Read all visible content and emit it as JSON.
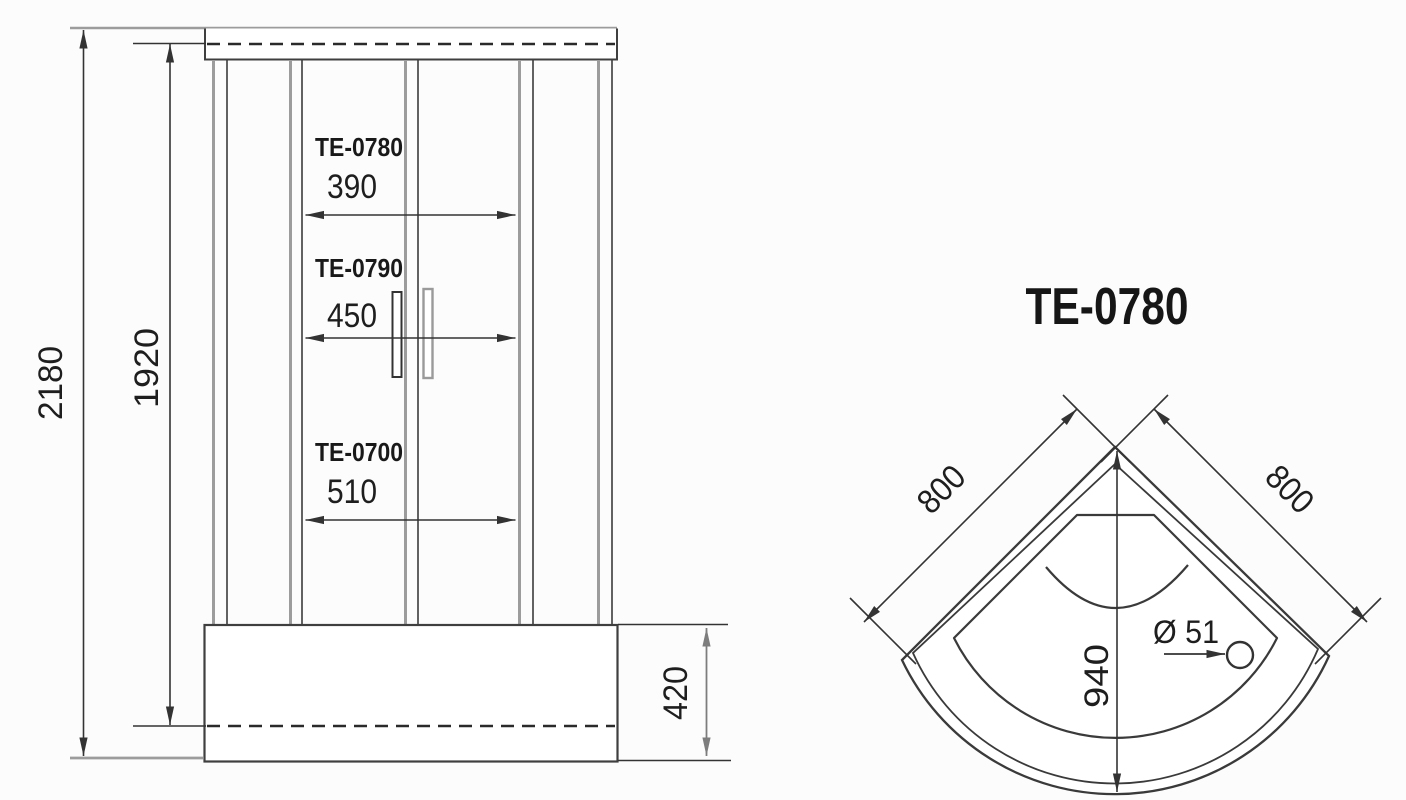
{
  "drawing": {
    "front_view": {
      "overall_height": "2180",
      "door_opening_height": "1920",
      "tray_height": "420",
      "variants": [
        {
          "model": "TE-0780",
          "door_width": "390"
        },
        {
          "model": "TE-0790",
          "door_width": "450"
        },
        {
          "model": "TE-0700",
          "door_width": "510"
        }
      ]
    },
    "plan_view": {
      "title": "TE-0780",
      "side_left": "800",
      "side_right": "800",
      "depth_diagonal": "940",
      "drain_diameter": "Ø 51"
    },
    "colors": {
      "line_dark": "#3a3a3a",
      "line_gray": "#9c9c9c",
      "background": "#fcfcfc",
      "text": "#1e1e1e"
    }
  }
}
